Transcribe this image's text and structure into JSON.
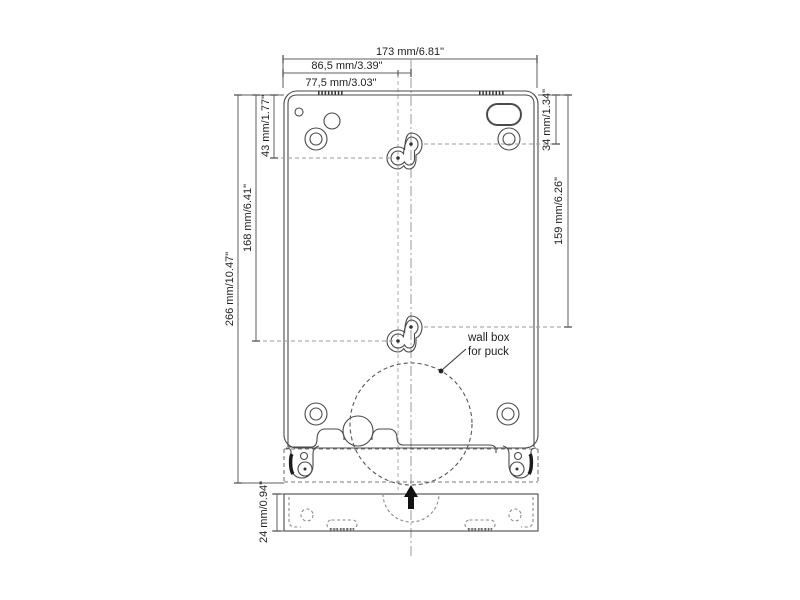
{
  "page": {
    "background": "#ffffff"
  },
  "colors": {
    "outline": "#4a4a4a",
    "dimension": "#5f5f5f",
    "reference": "#9a9a9a",
    "text": "#1f1f1f",
    "fill_dark": "#111111"
  },
  "dims": {
    "width_total": "173 mm/6.81\"",
    "width_to_center": "86,5 mm/3.39\"",
    "width_to_hole": "77,5 mm/3.03\"",
    "hole_top_left": "43 mm/1.77\"",
    "holes_span_left": "168 mm/6.41\"",
    "height_total": "266 mm/10.47\"",
    "hole_top_right": "34 mm/1.34\"",
    "holes_span_right": "159 mm/6.26\"",
    "depth": "24 mm/0.94\""
  },
  "annotation": {
    "wall_box_line1": "wall box",
    "wall_box_line2": "for puck"
  },
  "icons": {
    "insert_direction": "arrow-up-icon"
  }
}
